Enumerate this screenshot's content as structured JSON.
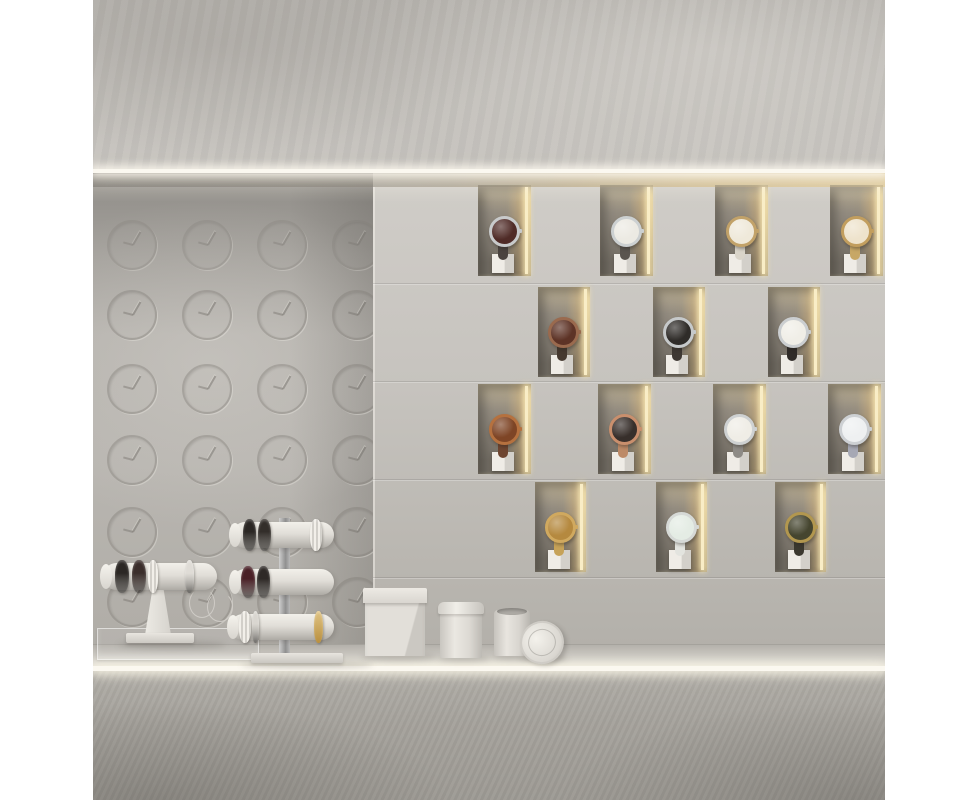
{
  "scene": {
    "title": "minimalist-watch-store-display-render",
    "description": "3D render of a concrete watch boutique wall: embossed clock motifs on the left, staggered illuminated niches with wristwatches on the right, LED light strips, and a counter with bracelet T-bar stands, a square box, canisters and a leaning lid.",
    "canvas": {
      "width": 978,
      "height": 800
    },
    "margins": {
      "left": 93,
      "right": 93,
      "color": "#ffffff"
    }
  },
  "palette": {
    "margin_white": "#ffffff",
    "upper_wall": "#bcb9b4",
    "light_strip": "#fbf8f0",
    "clock_wall": "#b3b0ab",
    "clock_line": "rgba(128,124,118,0.5)",
    "panel_wall": "#cbc8c3",
    "niche_dark": "#8f897e",
    "niche_glow": "#f4e5b8",
    "counter_top": "#ccc9c3",
    "counter_front": "#a8a5a0",
    "item_white": "#e6e3dd",
    "chrome": "#b5b5b5",
    "gold": "#c9a65c",
    "maroon": "#4a2026",
    "black_band": "#2b2724",
    "pearl": "#ece9e3"
  },
  "lighting": {
    "top_strip": {
      "x": 0,
      "y": 169,
      "w": 792,
      "h": 4
    },
    "counter_strip": {
      "x": 0,
      "y": 666,
      "w": 792,
      "h": 5
    }
  },
  "upper_wall": {
    "x": 0,
    "y": 0,
    "w": 792,
    "h": 170
  },
  "clock_wall": {
    "x": 0,
    "y": 173,
    "w": 280,
    "h": 475,
    "motif": "embossed-clock-circle",
    "diameter": 46,
    "col_centers": [
      37,
      112,
      187,
      262
    ],
    "row_centers": [
      243,
      313,
      387,
      458,
      530,
      600
    ]
  },
  "display_wall": {
    "x": 280,
    "y": 173,
    "w": 512,
    "h": 475,
    "seams_y": [
      283,
      381,
      479,
      577
    ],
    "rows": [
      {
        "y": 185,
        "h": 91,
        "niche_w": 53,
        "niches": [
          {
            "x": 105,
            "watch": {
              "label": "maroon-dial-silver-watch",
              "dial": "#4f2b27",
              "case": "#c8cacb",
              "strap": "#4a433f"
            }
          },
          {
            "x": 227,
            "watch": {
              "label": "white-dial-silver-watch",
              "dial": "#eceae3",
              "case": "#ccd0d1",
              "strap": "#5a554f"
            }
          },
          {
            "x": 342,
            "watch": {
              "label": "white-dial-gold-watch-white-strap",
              "dial": "#efe9da",
              "case": "#c2a269",
              "strap": "#d9d4c9"
            }
          },
          {
            "x": 457,
            "watch": {
              "label": "cream-dial-gold-watch-gold-strap",
              "dial": "#eee3cc",
              "case": "#c29e5e",
              "strap": "#c7a766"
            }
          }
        ]
      },
      {
        "y": 287,
        "h": 90,
        "niche_w": 52,
        "niches": [
          {
            "x": 165,
            "watch": {
              "label": "brown-dial-copper-watch",
              "dial": "#5d3326",
              "case": "#9a6a4e",
              "strap": "#45392f"
            }
          },
          {
            "x": 280,
            "watch": {
              "label": "black-dial-silver-watch",
              "dial": "#2f2c29",
              "case": "#c6c9ca",
              "strap": "#3e3833"
            }
          },
          {
            "x": 395,
            "watch": {
              "label": "white-dial-black-strap-watch",
              "dial": "#f0eee7",
              "case": "#cbced0",
              "strap": "#2f2b28"
            }
          }
        ]
      },
      {
        "y": 384,
        "h": 90,
        "niche_w": 53,
        "niches": [
          {
            "x": 105,
            "watch": {
              "label": "copper-dial-copper-watch",
              "dial": "#7e4526",
              "case": "#b5713f",
              "strap": "#6e4530"
            }
          },
          {
            "x": 225,
            "watch": {
              "label": "black-dial-rosegold-watch",
              "dial": "#372f2b",
              "case": "#c98f6d",
              "strap": "#bd8a67"
            }
          },
          {
            "x": 340,
            "watch": {
              "label": "white-dial-gray-strap-watch",
              "dial": "#efede6",
              "case": "#ced1d2",
              "strap": "#8e8b86"
            }
          },
          {
            "x": 455,
            "watch": {
              "label": "white-dial-blue-gray-strap-watch",
              "dial": "#eef0f1",
              "case": "#cdd0d3",
              "strap": "#a6a8b4"
            }
          }
        ]
      },
      {
        "y": 482,
        "h": 90,
        "niche_w": 51,
        "niches": [
          {
            "x": 162,
            "watch": {
              "label": "gold-bracelet-watch",
              "dial": "#b5893f",
              "case": "#d0a95f",
              "strap": "#c6a258"
            }
          },
          {
            "x": 283,
            "watch": {
              "label": "mint-white-watch",
              "dial": "#e4ece4",
              "case": "#d6d9d6",
              "strap": "#e3e4df"
            }
          },
          {
            "x": 402,
            "watch": {
              "label": "olive-dial-gold-rim-watch",
              "dial": "#45452f",
              "case": "#b2974f",
              "strap": "#3b382f"
            }
          }
        ]
      }
    ]
  },
  "counter": {
    "surface": {
      "y": 644,
      "h": 22
    },
    "front": {
      "y": 671,
      "h": 129
    }
  },
  "items": {
    "acrylic_tray": {
      "label": "clear-acrylic-tray",
      "x": 4,
      "y": 628,
      "w": 160,
      "h": 30
    },
    "single_stand": {
      "label": "white-single-tier-bracelet-stand",
      "bar": {
        "x": 10,
        "y": 563,
        "w": 114,
        "h": 27
      },
      "rings": [
        {
          "x": 22,
          "w": 14,
          "color": "#2b2724",
          "label": "black-bangle"
        },
        {
          "x": 39,
          "w": 14,
          "color": "#3b2e2b",
          "label": "dark-bangle"
        },
        {
          "x": 55,
          "w": 10,
          "color": "pearl",
          "label": "pearl-bracelet"
        },
        {
          "x": 92,
          "w": 9,
          "color": "#dfdcd6",
          "label": "white-ring"
        }
      ],
      "stem": {
        "x": 52,
        "y": 590,
        "w": 26,
        "h": 45
      },
      "base": {
        "x": 33,
        "y": 633,
        "w": 68,
        "h": 10
      },
      "charms": [
        {
          "x": 96,
          "y": 588
        },
        {
          "x": 114,
          "y": 592
        }
      ]
    },
    "tiered_stand": {
      "label": "white-three-tier-bracelet-stand",
      "stem": {
        "x": 186,
        "y": 518,
        "w": 11,
        "h": 140
      },
      "bars": [
        {
          "x": 139,
          "y": 522,
          "w": 102,
          "h": 26,
          "rings": [
            {
              "x": 150,
              "w": 13,
              "color": "#2b2724",
              "label": "black-bangle"
            },
            {
              "x": 165,
              "w": 13,
              "color": "#332e2a",
              "label": "black-bangle"
            },
            {
              "x": 217,
              "w": 12,
              "color": "pearl",
              "label": "pearl-bracelet"
            }
          ]
        },
        {
          "x": 139,
          "y": 569,
          "w": 102,
          "h": 26,
          "rings": [
            {
              "x": 148,
              "w": 14,
              "color": "#4a2026",
              "label": "maroon-bangle"
            },
            {
              "x": 164,
              "w": 13,
              "color": "#2e2926",
              "label": "black-bangle"
            }
          ]
        },
        {
          "x": 137,
          "y": 614,
          "w": 104,
          "h": 26,
          "rings": [
            {
              "x": 146,
              "w": 12,
              "color": "pearl",
              "label": "pearl-bracelet"
            },
            {
              "x": 159,
              "w": 7,
              "color": "#d9d6d0",
              "label": "silver-bracelet"
            },
            {
              "x": 221,
              "w": 9,
              "color": "gold",
              "label": "gold-bangle"
            }
          ]
        }
      ],
      "base": {
        "x": 158,
        "y": 653,
        "w": 92,
        "h": 10
      }
    },
    "square_box": {
      "label": "white-square-gift-box",
      "x": 272,
      "y": 588,
      "w": 60,
      "h": 68,
      "lid_h": 15
    },
    "canister_tall": {
      "label": "white-canister-with-lid",
      "x": 347,
      "y": 602,
      "w": 42,
      "h": 56,
      "lid_h": 12
    },
    "canister_short": {
      "label": "white-open-canister",
      "x": 401,
      "y": 610,
      "w": 36,
      "h": 46
    },
    "leaning_lid": {
      "label": "round-lid-leaning",
      "x": 427,
      "y": 621,
      "w": 40,
      "h": 39,
      "rot": -22
    }
  }
}
